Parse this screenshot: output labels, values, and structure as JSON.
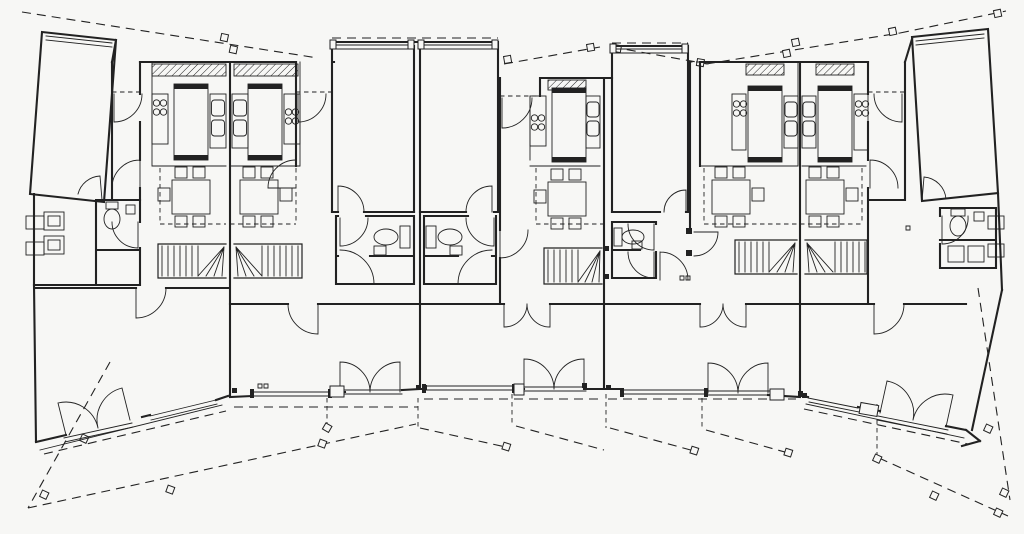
{
  "colors": {
    "paper": "#f7f7f5",
    "ink": "#222222"
  },
  "drawing": {
    "type": "architectural-floor-plan",
    "subject": "ground floor plan of five terraced dwellings arranged in a splayed (fan-shaped) row",
    "style": "black ink line drawing on white paper, no text or dimensions visible",
    "units": [
      {
        "id": "unit-1",
        "position": "left-end",
        "orientation": "splayed-left",
        "rooms": [
          "garage",
          "entry-porch",
          "hall",
          "kitchen",
          "dining-area",
          "utility-room",
          "bathroom",
          "winder-stair",
          "living-room"
        ],
        "exterior": [
          "garage-door",
          "entry-door",
          "french-doors-to-garden",
          "terrace"
        ]
      },
      {
        "id": "unit-2",
        "position": "inner-row",
        "orientation": "straight",
        "rooms": [
          "garage",
          "entry-porch",
          "hall",
          "kitchen",
          "dining-area",
          "bathroom",
          "storage-room",
          "winder-stair",
          "living-room"
        ],
        "exterior": [
          "garage-door",
          "entry-door",
          "french-doors-to-garden",
          "window-band"
        ]
      },
      {
        "id": "unit-3",
        "position": "inner-row-center-left",
        "orientation": "straight",
        "rooms": [
          "garage",
          "entry-porch",
          "hall",
          "kitchen",
          "dining-area",
          "bathroom",
          "storage-room",
          "winder-stair",
          "living-room"
        ],
        "exterior": [
          "garage-door",
          "entry-door",
          "french-doors-to-garden",
          "window-band"
        ]
      },
      {
        "id": "unit-4",
        "position": "inner-row-center-right",
        "orientation": "straight",
        "rooms": [
          "garage",
          "side-entry",
          "hall",
          "kitchen",
          "dining-area",
          "bathroom",
          "storage-room",
          "winder-stair",
          "living-room"
        ],
        "exterior": [
          "garage-door",
          "entry-door",
          "french-doors-to-garden",
          "window-band"
        ]
      },
      {
        "id": "unit-5",
        "position": "right-end",
        "orientation": "splayed-right",
        "rooms": [
          "garage",
          "entry-porch",
          "hall",
          "kitchen",
          "dining-area",
          "utility-room",
          "bathroom",
          "winder-stair",
          "living-room"
        ],
        "exterior": [
          "garage-door",
          "entry-door",
          "french-doors-to-garden",
          "terrace"
        ]
      }
    ],
    "fixtures": {
      "kitchen": [
        "four-burner-hob",
        "double-sink",
        "worktop-island",
        "hatched-counter"
      ],
      "dining": [
        "table",
        "four-chairs",
        "side-chair"
      ],
      "bathroom": [
        "toilet",
        "cistern",
        "washbasin"
      ],
      "utility": [
        "appliances",
        "wall-windows"
      ],
      "stair": "quarter-turn-winder-stair",
      "doors": [
        "single-swing-door",
        "double-french-door",
        "garage-door"
      ]
    },
    "site": {
      "canopy_lines": "dashed canopy/roof edge lines with small posts, sloping outward at both ends",
      "garden_boundaries": "dashed plot boundary lines with tilted fence posts fanning out below the houses"
    }
  }
}
